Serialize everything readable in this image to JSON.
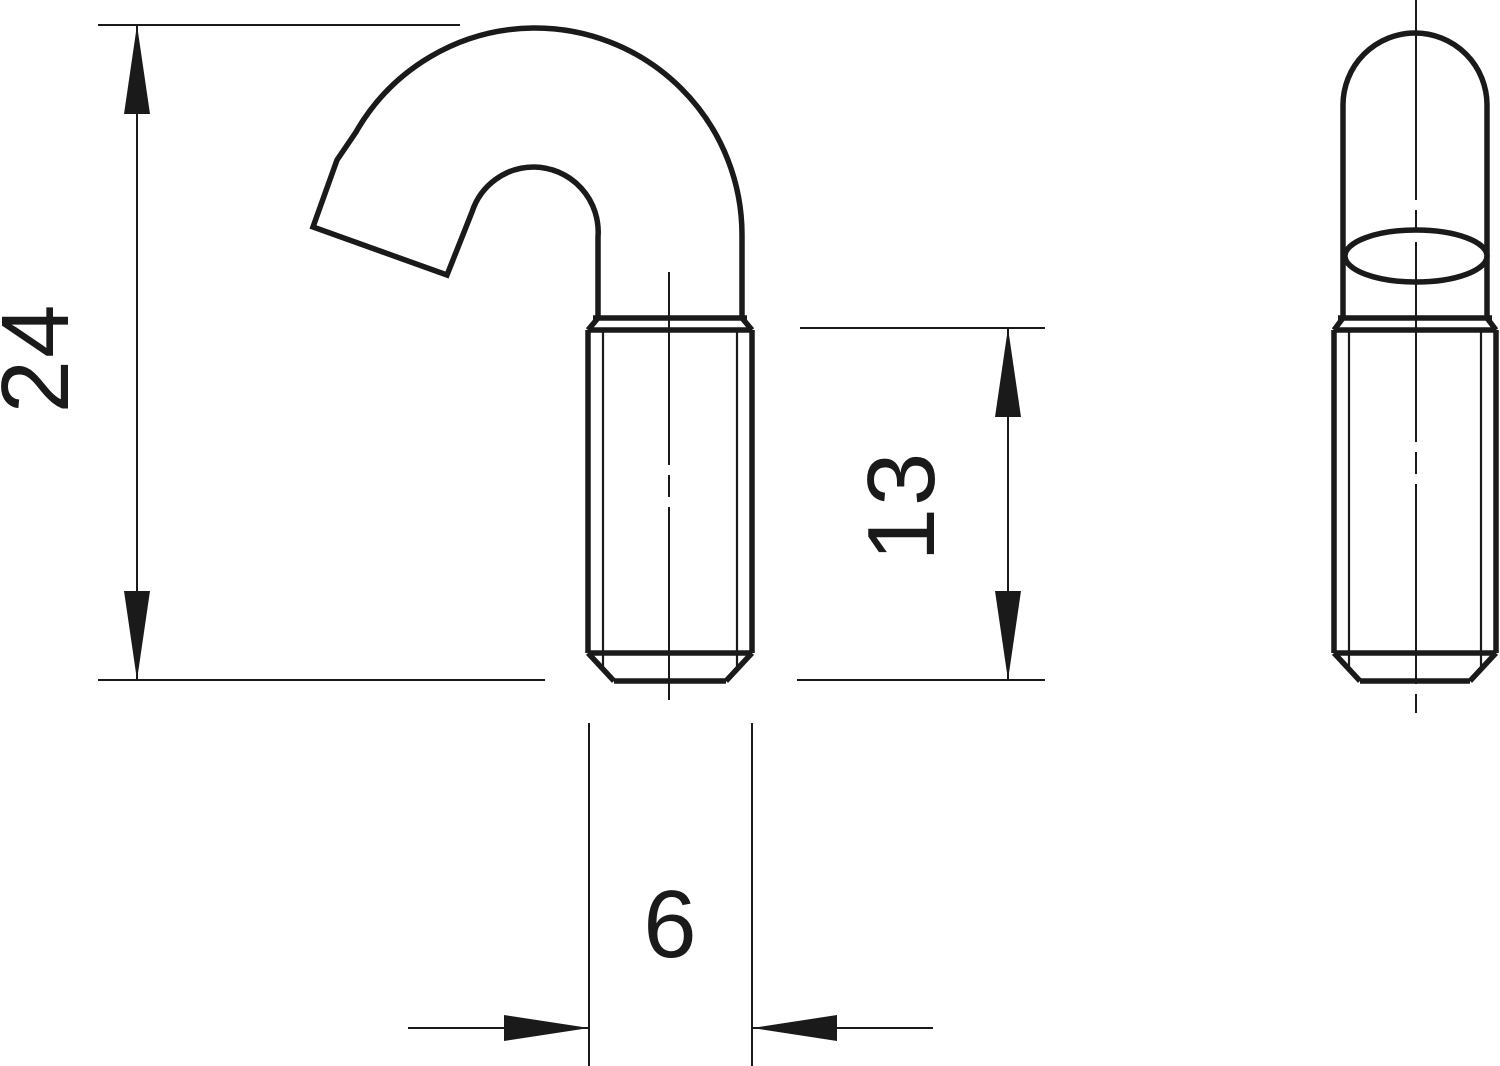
{
  "colors": {
    "line": "#1a1a1a",
    "background": "#ffffff"
  },
  "dimensions": {
    "overall_height": {
      "value": "24",
      "orientation": "vertical"
    },
    "thread_length": {
      "value": "13",
      "orientation": "vertical"
    },
    "thread_diameter": {
      "value": "6",
      "orientation": "horizontal"
    }
  }
}
